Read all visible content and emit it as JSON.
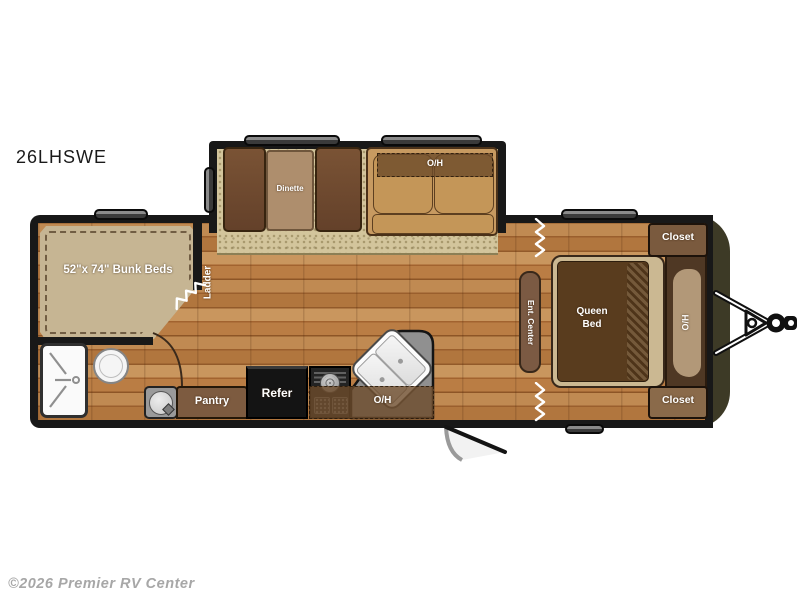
{
  "title": "26LHSWE",
  "watermark": "©2026 Premier RV Center",
  "rooms": {
    "dinette": {
      "label": "Dinette"
    },
    "sofa": {
      "overhead_label": "O/H"
    },
    "bunk": {
      "label": "52\"x 74\" Bunk Beds",
      "ladder_label": "Ladder"
    },
    "kitchen": {
      "pantry_label": "Pantry",
      "refrigerator_label": "Refer",
      "overhead_label": "O/H"
    },
    "living": {
      "ent_center_label": "Ent. Center"
    },
    "bedroom": {
      "bed_label_line1": "Queen",
      "bed_label_line2": "Bed",
      "overhead_label": "O/H",
      "closet_front_label": "Closet",
      "closet_rear_label": "Closet"
    }
  },
  "colors": {
    "wall": "#181818",
    "front_cap": "#3d3a26",
    "wood_floor": "#b1763e",
    "carpet": "#d3c59c",
    "cabinet_brown": "#7d5b40",
    "counter_gray": "#909090",
    "label_text": "#ffffff"
  }
}
